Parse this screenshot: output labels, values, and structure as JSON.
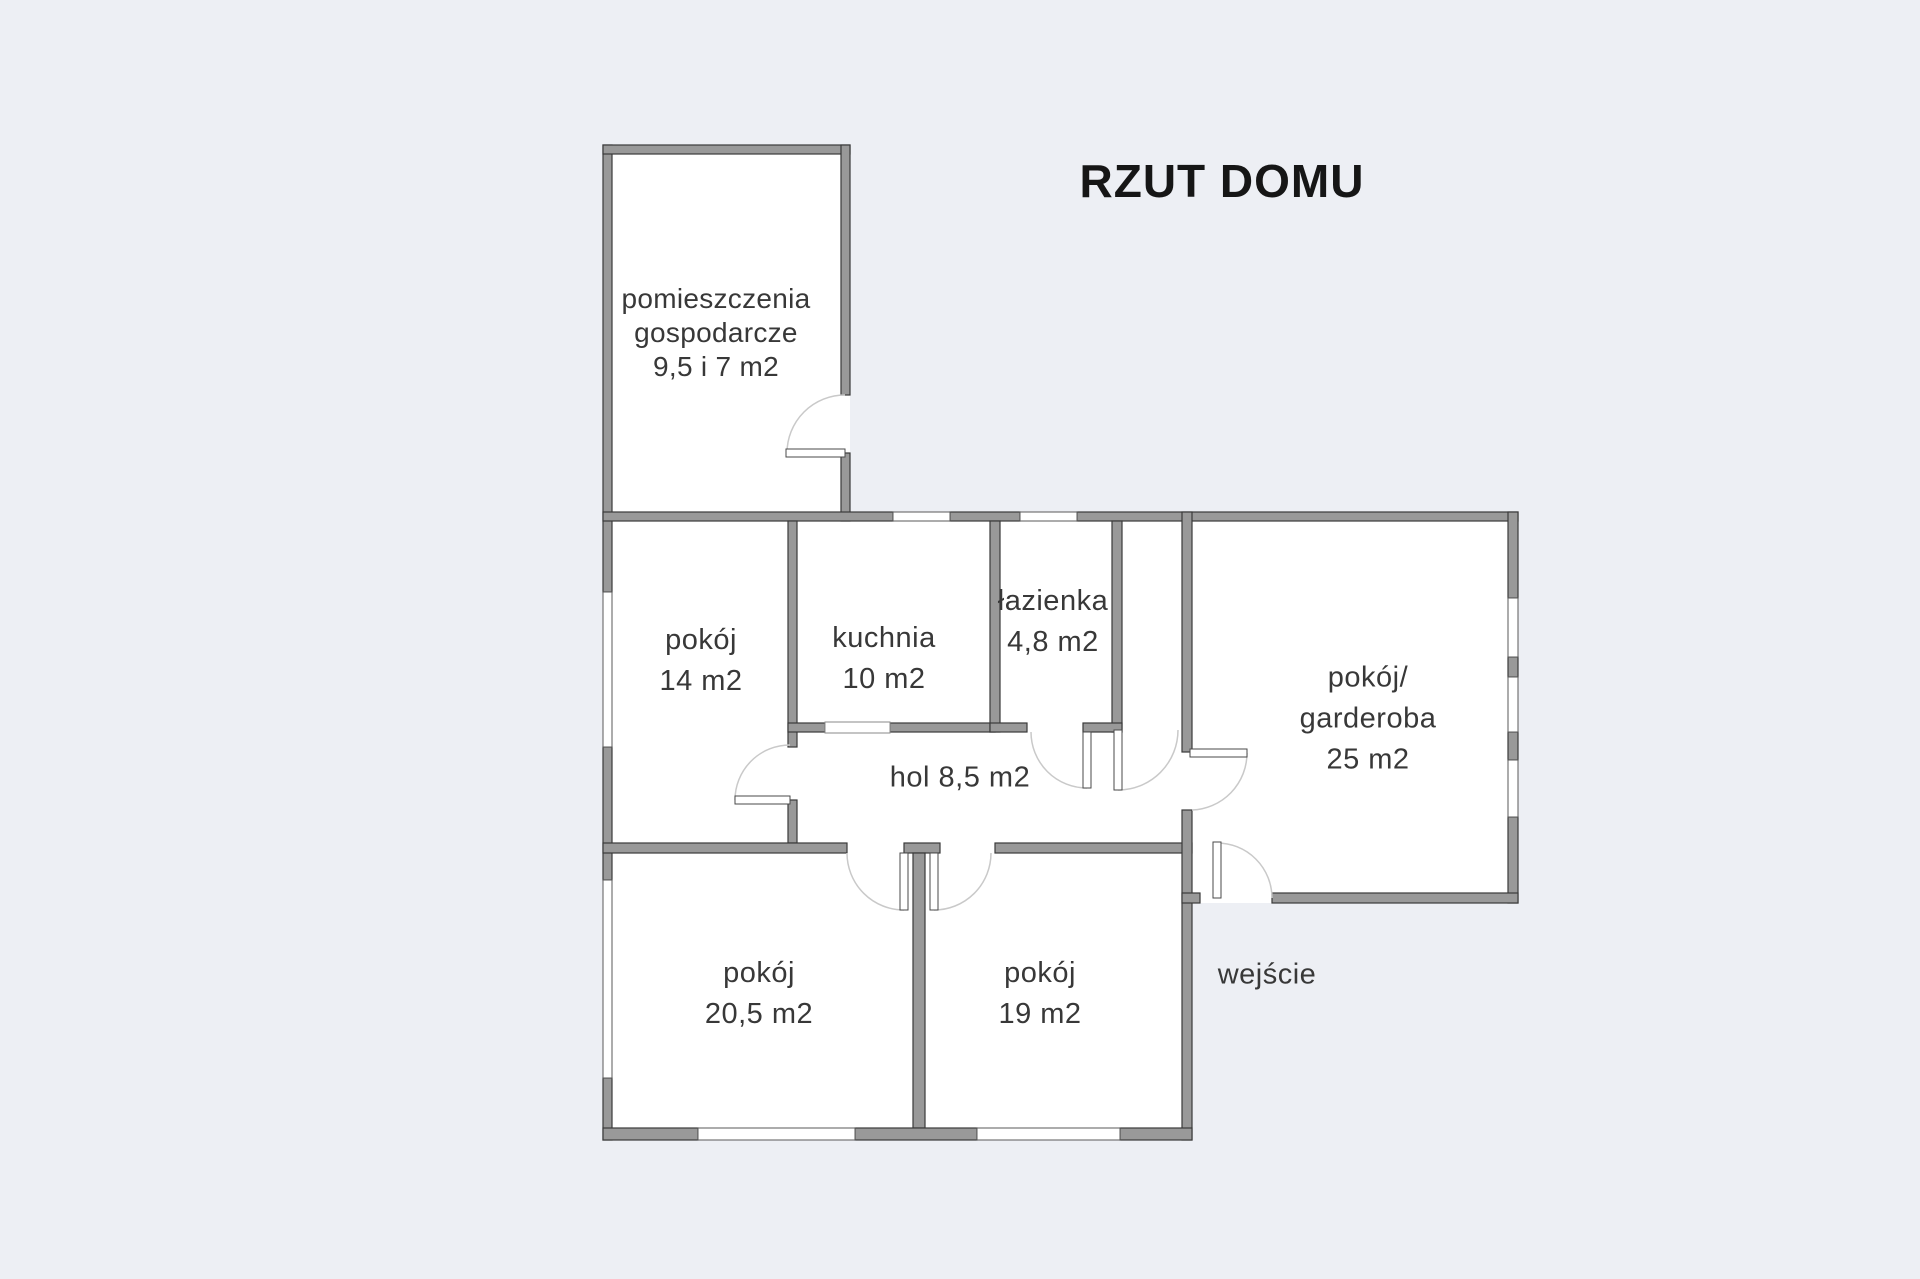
{
  "title": "RZUT DOMU",
  "colors": {
    "background": "#edeff4",
    "wall": "#999999",
    "wall_outline": "#3a3a3a",
    "room_fill": "#ffffff",
    "text": "#383838",
    "title_text": "#161616",
    "door_arc": "#c9c9c9",
    "window_outline": "#5a5a5a"
  },
  "rooms": [
    {
      "id": "utility-room",
      "lines": [
        "pomieszczenia",
        "gospodarcze",
        "9,5 i 7 m2"
      ]
    },
    {
      "id": "room-14",
      "lines": [
        "pokój",
        "14 m2"
      ]
    },
    {
      "id": "kitchen",
      "lines": [
        "kuchnia",
        "10 m2"
      ]
    },
    {
      "id": "bathroom",
      "lines": [
        "łazienka",
        "4,8 m2"
      ]
    },
    {
      "id": "hall",
      "lines": [
        "hol 8,5 m2"
      ]
    },
    {
      "id": "wardrobe-room",
      "lines": [
        "pokój/",
        "garderoba",
        "25 m2"
      ]
    },
    {
      "id": "room-205",
      "lines": [
        "pokój",
        "20,5 m2"
      ]
    },
    {
      "id": "room-19",
      "lines": [
        "pokój",
        "19 m2"
      ]
    },
    {
      "id": "entrance",
      "lines": [
        "wejście"
      ]
    }
  ]
}
